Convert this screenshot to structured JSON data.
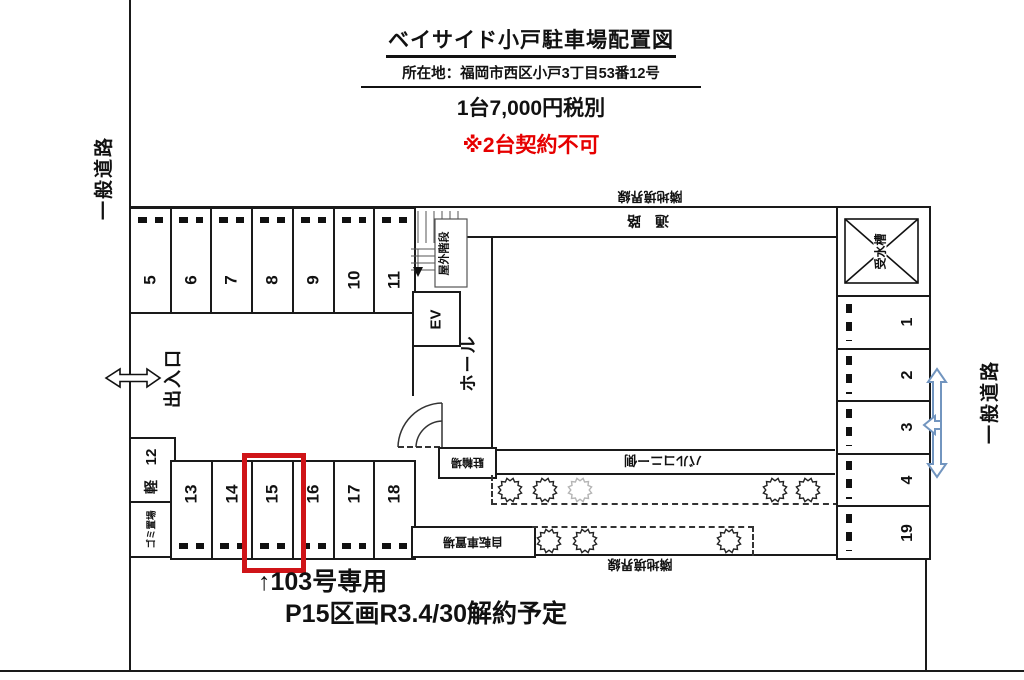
{
  "header": {
    "title": "ベイサイド小戸駐車場配置図",
    "address": "所在地：福岡市西区小戸3丁目53番12号",
    "price": "1台7,000円税別",
    "warning": "※2台契約不可"
  },
  "roads": {
    "left": "一般道路",
    "right": "一般道路"
  },
  "facility": {
    "entrance": "出入口",
    "hall": "ホール",
    "elevator": "EV",
    "outdoor_stairs": "屋外階段",
    "corridor": "通　路",
    "boundary_line_top": "隣地境界線",
    "boundary_line_bottom": "隣地境界線",
    "balcony_side": "バルコニー側",
    "bike_rack": "駐輪場",
    "bicycle_storage": "自転車置場",
    "water_tank": "受水槽",
    "kei": "軽",
    "garbage_area": "ゴミ置場"
  },
  "spaces": {
    "top_row": [
      "5",
      "6",
      "7",
      "8",
      "9",
      "10",
      "11"
    ],
    "left_kei": "12",
    "bottom_row": [
      "13",
      "14",
      "15",
      "16",
      "17",
      "18"
    ],
    "right_column": [
      "1",
      "2",
      "3",
      "4",
      "19"
    ],
    "highlighted_space": "15"
  },
  "notes": {
    "line1": "↑103号専用",
    "line2": "P15区画R3.4/30解約予定"
  },
  "colors": {
    "highlight_box": "#cf1418",
    "warning_text": "#e60000",
    "road_arrow": "#7295bf"
  }
}
